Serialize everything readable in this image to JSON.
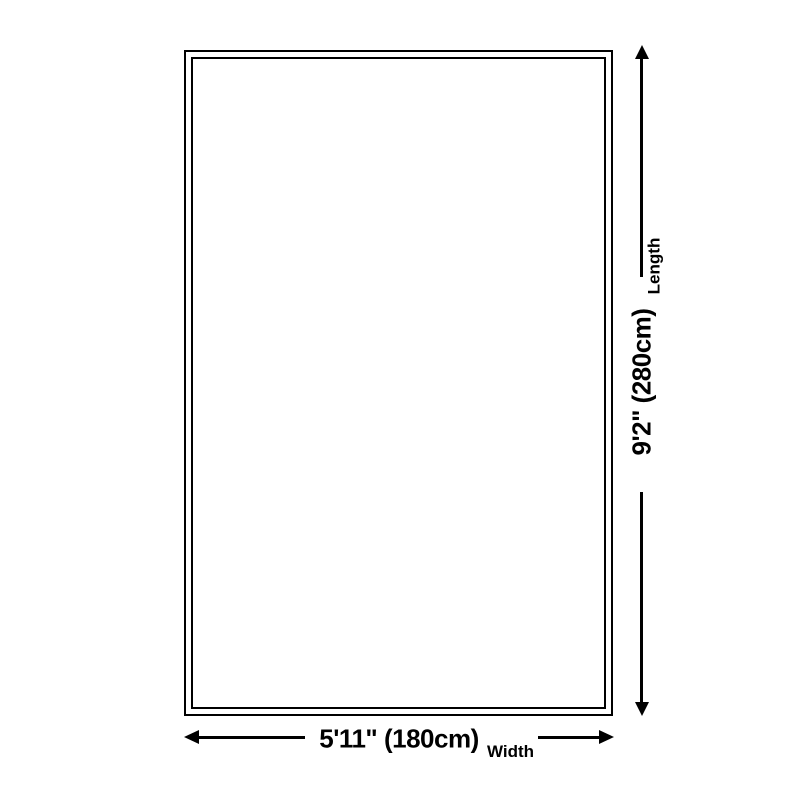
{
  "diagram": {
    "type": "rug-size-diagram",
    "colors": {
      "background": "#ffffff",
      "line": "#000000",
      "text": "#000000"
    },
    "rug": {
      "shape": "rectangle",
      "fill": "#ffffff",
      "border_color": "#000000",
      "border_style": "double"
    },
    "width_dimension": {
      "value": "5'11\" (180cm)",
      "label": "Width"
    },
    "length_dimension": {
      "value": "9'2\" (280cm)",
      "label": "Length"
    }
  }
}
